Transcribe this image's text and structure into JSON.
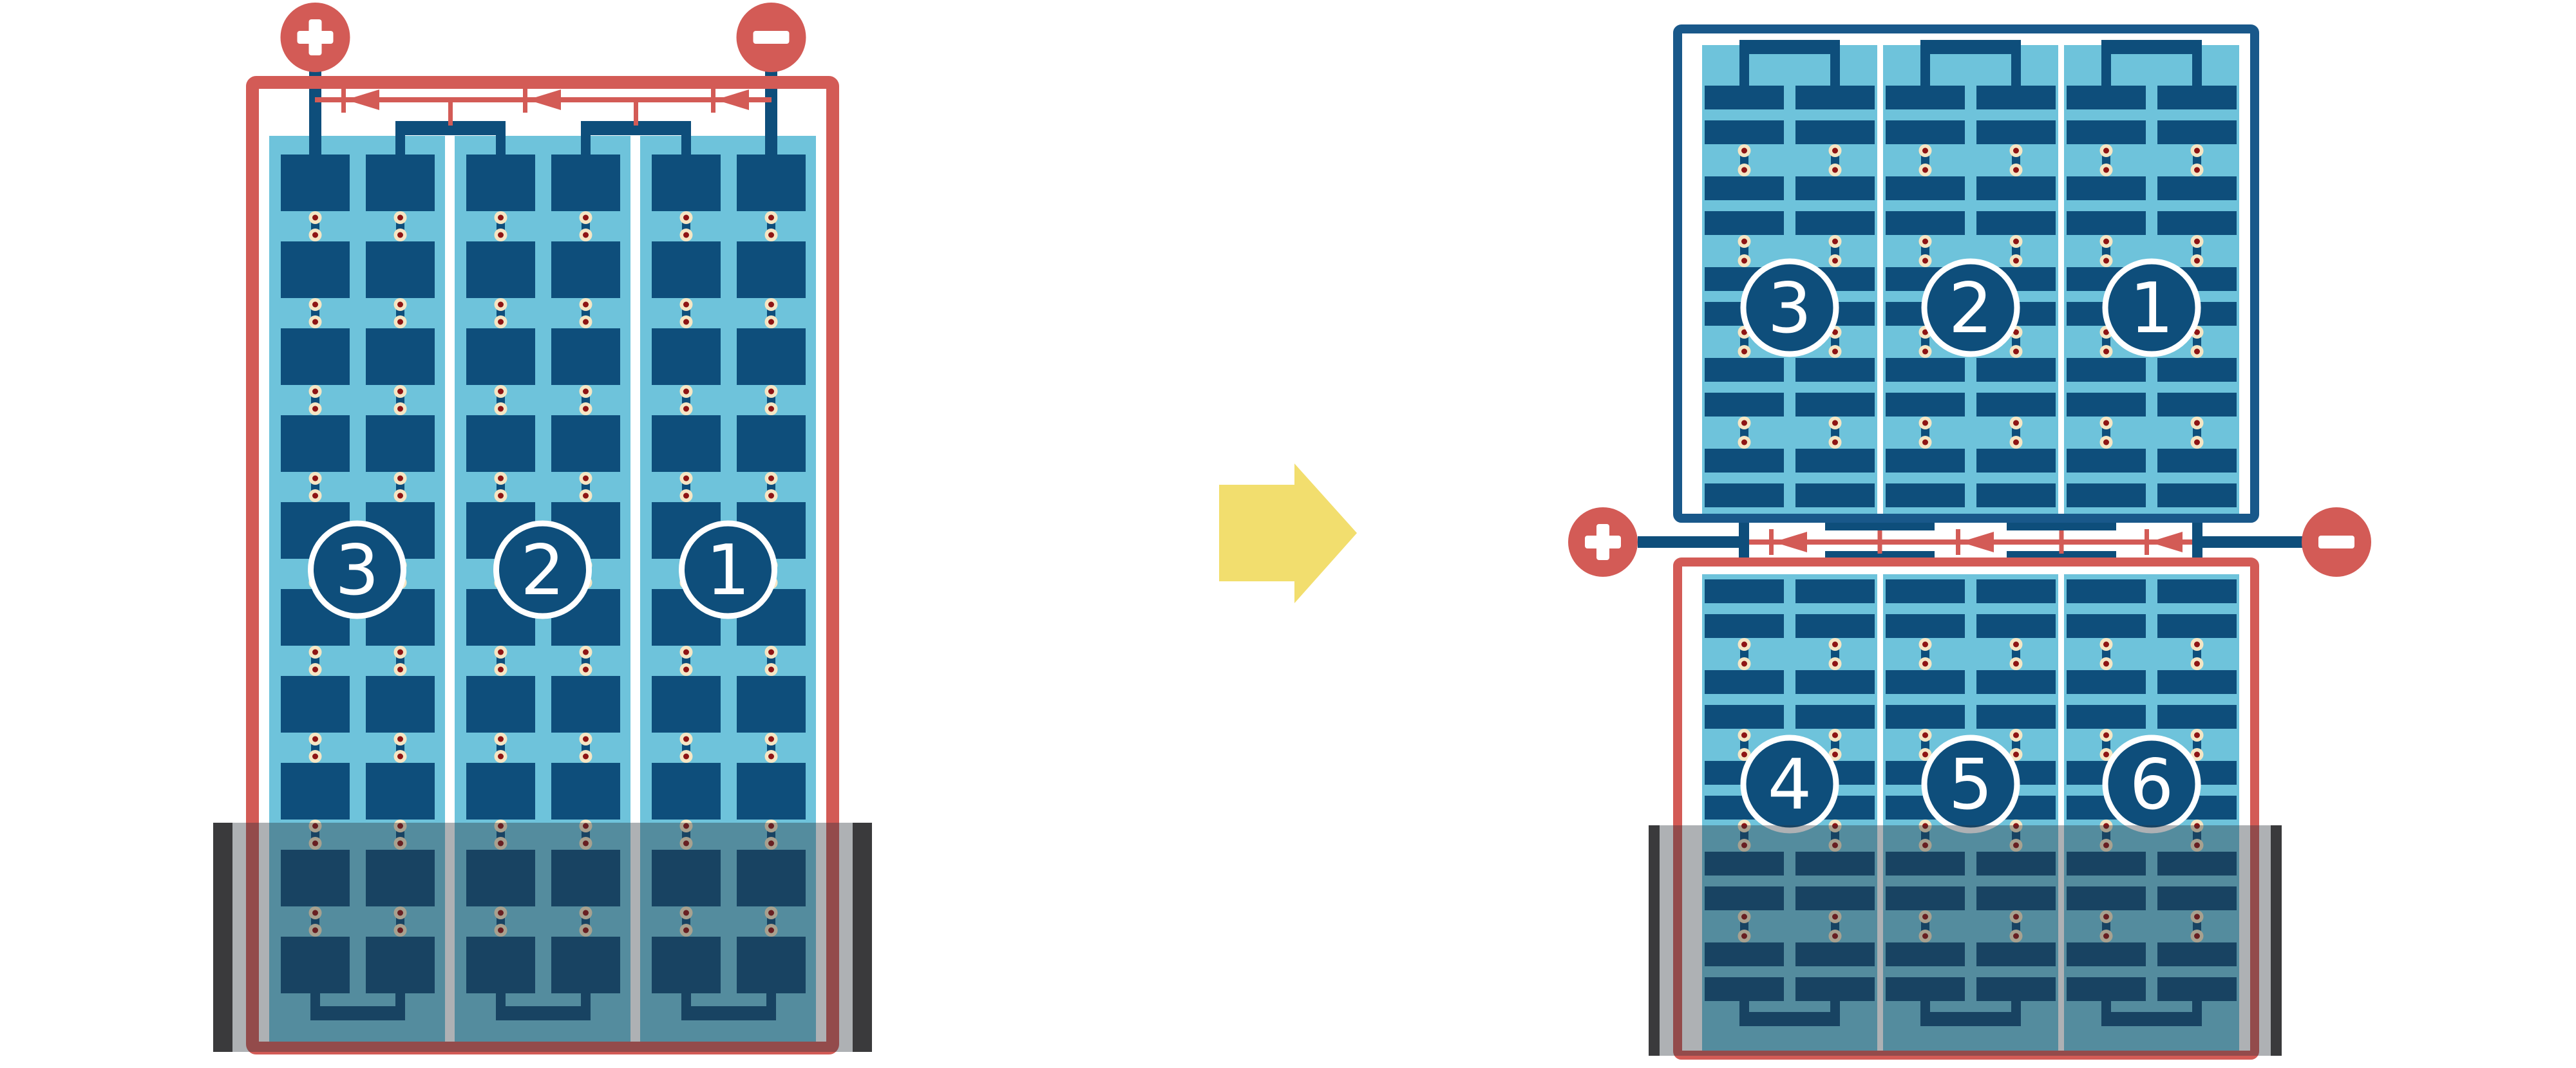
{
  "colors": {
    "red": "#D35B56",
    "cell_blue": "#0E4E7B",
    "frame_blue": "#19588A",
    "light_blue": "#6EC3DB",
    "dot_cream": "#F5E6C4",
    "dot_maroon": "#8E1414",
    "flood": "rgba(43,49,58,0.38)",
    "flood_bar": "#3A3A3C",
    "arrow_yellow": "#F2DE6E"
  },
  "modules": {
    "before": {
      "terminals": {
        "positive": "+",
        "negative": "−"
      },
      "strings": [
        "3",
        "2",
        "1"
      ]
    },
    "after_top": {
      "strings": [
        "3",
        "2",
        "1"
      ]
    },
    "after_bottom": {
      "strings": [
        "4",
        "5",
        "6"
      ]
    },
    "after_terminals": {
      "positive": "+",
      "negative": "−"
    },
    "arrow_direction": "right"
  }
}
